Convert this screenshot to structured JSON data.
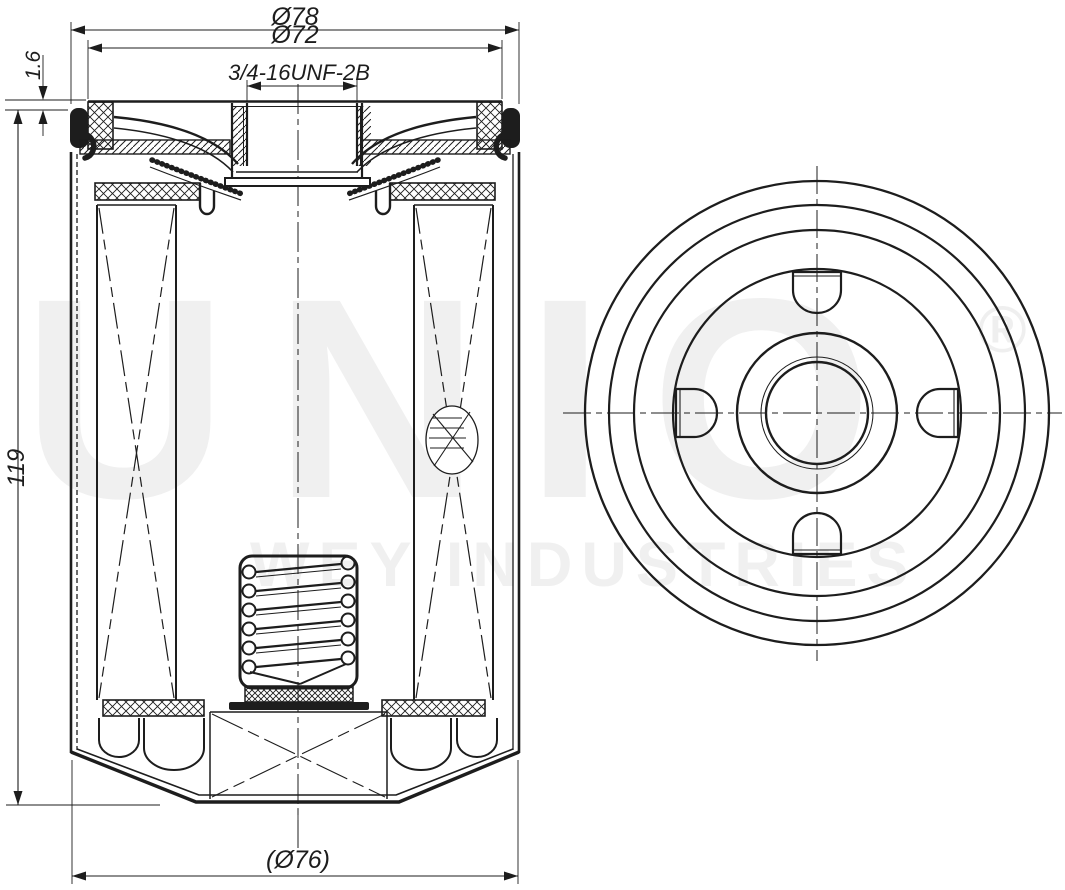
{
  "colors": {
    "background": "#ffffff",
    "line": "#1d1d1d",
    "watermark": "#f0f0f0"
  },
  "dimensions": {
    "outer_diameter_top": "Ø78",
    "gasket_diameter": "Ø72",
    "thread_spec": "3/4-16UNF-2B",
    "seam_height": "1.6",
    "body_height": "119",
    "bottom_diameter": "(Ø76)"
  },
  "watermark": {
    "brand": "UNIO",
    "registered_mark": "®",
    "subtitle": "WEY INDUSTRIES"
  }
}
